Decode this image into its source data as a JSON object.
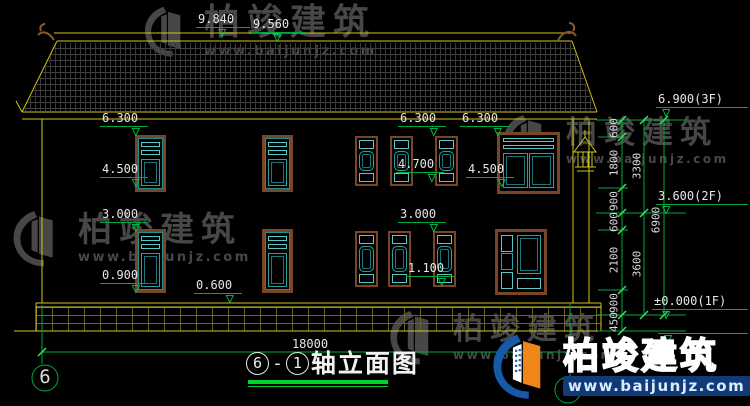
{
  "watermarks": {
    "brand": "柏竣建筑",
    "url": "www.baijunjz.com"
  },
  "footer_logo": {
    "brand": "柏竣建筑",
    "url": "www.baijunjz.com"
  },
  "elevation_markers": [
    {
      "label": "9.840"
    },
    {
      "label": "9.560"
    },
    {
      "label": "6.300"
    },
    {
      "label": "4.500"
    },
    {
      "label": "3.000"
    },
    {
      "label": "0.900"
    },
    {
      "label": "0.600"
    },
    {
      "label": "6.300"
    },
    {
      "label": "4.700"
    },
    {
      "label": "6.300"
    },
    {
      "label": "4.500"
    },
    {
      "label": "3.000"
    },
    {
      "label": "1.100"
    },
    {
      "label": "6.900(3F)"
    },
    {
      "label": "3.600(2F)"
    },
    {
      "label": "±0.000(1F)"
    }
  ],
  "dimensions": {
    "chain_inner": [
      "600",
      "1800",
      "900",
      "600",
      "2100",
      "900",
      "450"
    ],
    "chain_mid": [
      "3300",
      "3600"
    ],
    "chain_outer": "6900",
    "total_width": "18000"
  },
  "axes": {
    "left_bubble": "6",
    "right_bubble": "1"
  },
  "title": {
    "axis_a": "6",
    "sep": "-",
    "axis_b": "1",
    "text": "轴立面图"
  },
  "colors": {
    "background": "#000000",
    "line_yellow": "#d2c31c",
    "dim_green": "#00a83e",
    "tick_green": "#3ddf5f",
    "window_teal": "#2aa0a0",
    "frame_brown": "#7a4527",
    "watermark_gray": "#474747",
    "logo_blue": "#1559a8",
    "logo_orange": "#f08519"
  }
}
